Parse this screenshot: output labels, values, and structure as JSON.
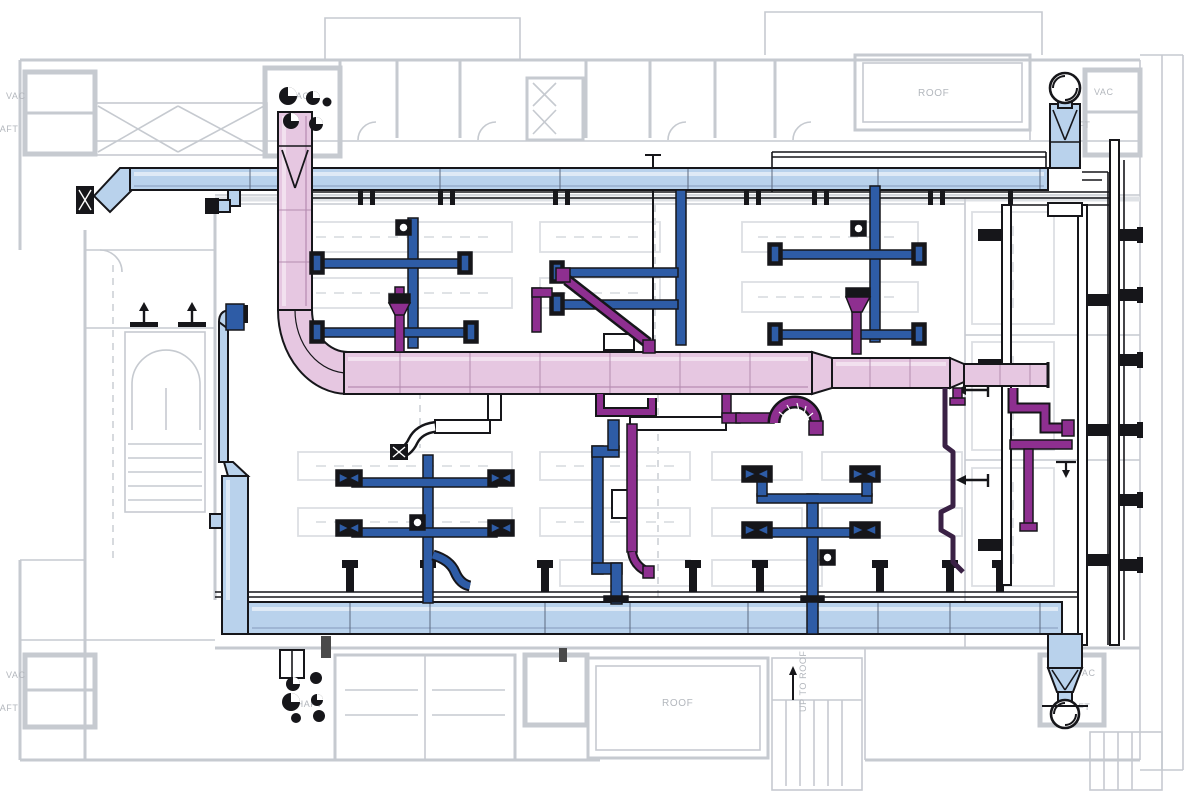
{
  "drawing": {
    "labels": {
      "vac_left_top": {
        "text": "VAC"
      },
      "shaft_left_top": {
        "text": "SHAFT"
      },
      "vac_shaft_top": {
        "text": "VAC"
      },
      "roof_top_right": {
        "text": "ROOF"
      },
      "vac_right_top": {
        "text": "VAC"
      },
      "shaft_right_top": {
        "text": "SHAFT"
      },
      "vac_left_bottom": {
        "text": "VAC"
      },
      "shaft_left_bottom": {
        "text": "SHAFT"
      },
      "shaft_bottom_mid": {
        "text": "SHAFT"
      },
      "roof_bottom": {
        "text": "ROOF"
      },
      "up_to_roof": {
        "text": "UP TO ROOF"
      },
      "vac_right_bottom": {
        "text": "VAC"
      },
      "shaft_right_bottom": {
        "text": "SHAFT"
      }
    },
    "colors": {
      "supply_duct": "#b9d2ec",
      "exhaust_trunk": "#e6c7e1",
      "lab_exhaust": "#2e5ca6",
      "process_exhaust": "#8e2f90",
      "dark_pipe": "#3a2145",
      "piping": "#16161a",
      "floorplan_gray": "#c6cad0",
      "furniture_gray": "#dcdfe3",
      "label_gray": "#b3b7bd",
      "background": "#ffffff"
    }
  }
}
